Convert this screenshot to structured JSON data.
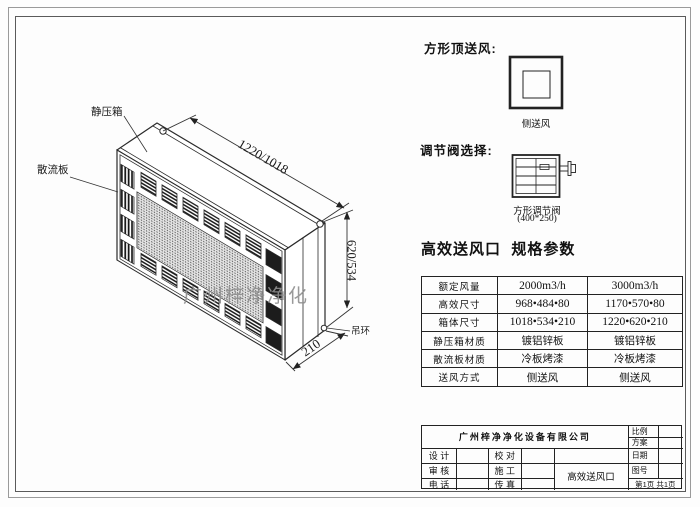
{
  "drawing": {
    "watermark": "广州梓净净化",
    "labels": {
      "static_pressure_box": "静压箱",
      "diffuser_plate": "散流板",
      "lifting_ring": "吊环"
    },
    "dimensions": {
      "length": "1220/1018",
      "height": "620/534",
      "depth": "210"
    }
  },
  "right_panel": {
    "top_supply_title": "方形顶送风:",
    "top_supply_caption": "侧送风",
    "valve_title": "调节阀选择:",
    "valve_caption": "方形调节阀",
    "valve_size": "(400*250)",
    "spec_title": "高效送风口  规格参数",
    "spec_rows": [
      {
        "label": "额定风量",
        "v1": "2000m3/h",
        "v2": "3000m3/h"
      },
      {
        "label": "高效尺寸",
        "v1": "968•484•80",
        "v2": "1170•570•80"
      },
      {
        "label": "箱体尺寸",
        "v1": "1018•534•210",
        "v2": "1220•620•210"
      },
      {
        "label": "静压箱材质",
        "v1": "镀铝锌板",
        "v2": "镀铝锌板"
      },
      {
        "label": "散流板材质",
        "v1": "冷板烤漆",
        "v2": "冷板烤漆"
      },
      {
        "label": "送风方式",
        "v1": "侧送风",
        "v2": "侧送风"
      }
    ]
  },
  "title_block": {
    "company": "广州梓净净化设备有限公司",
    "scale_label": "比例",
    "plan_label": "方案",
    "design_label": "设 计",
    "check_label": "校 对",
    "date_label": "日期",
    "review_label": "审 核",
    "construction_label": "施 工",
    "drawing_no_label": "图号",
    "phone_label": "电 话",
    "fax_label": "传 真",
    "product_name": "高效送风口",
    "page_info": "第1页 共1页"
  },
  "colors": {
    "line": "#2a2a2a",
    "watermark": "#8f8f8f"
  }
}
